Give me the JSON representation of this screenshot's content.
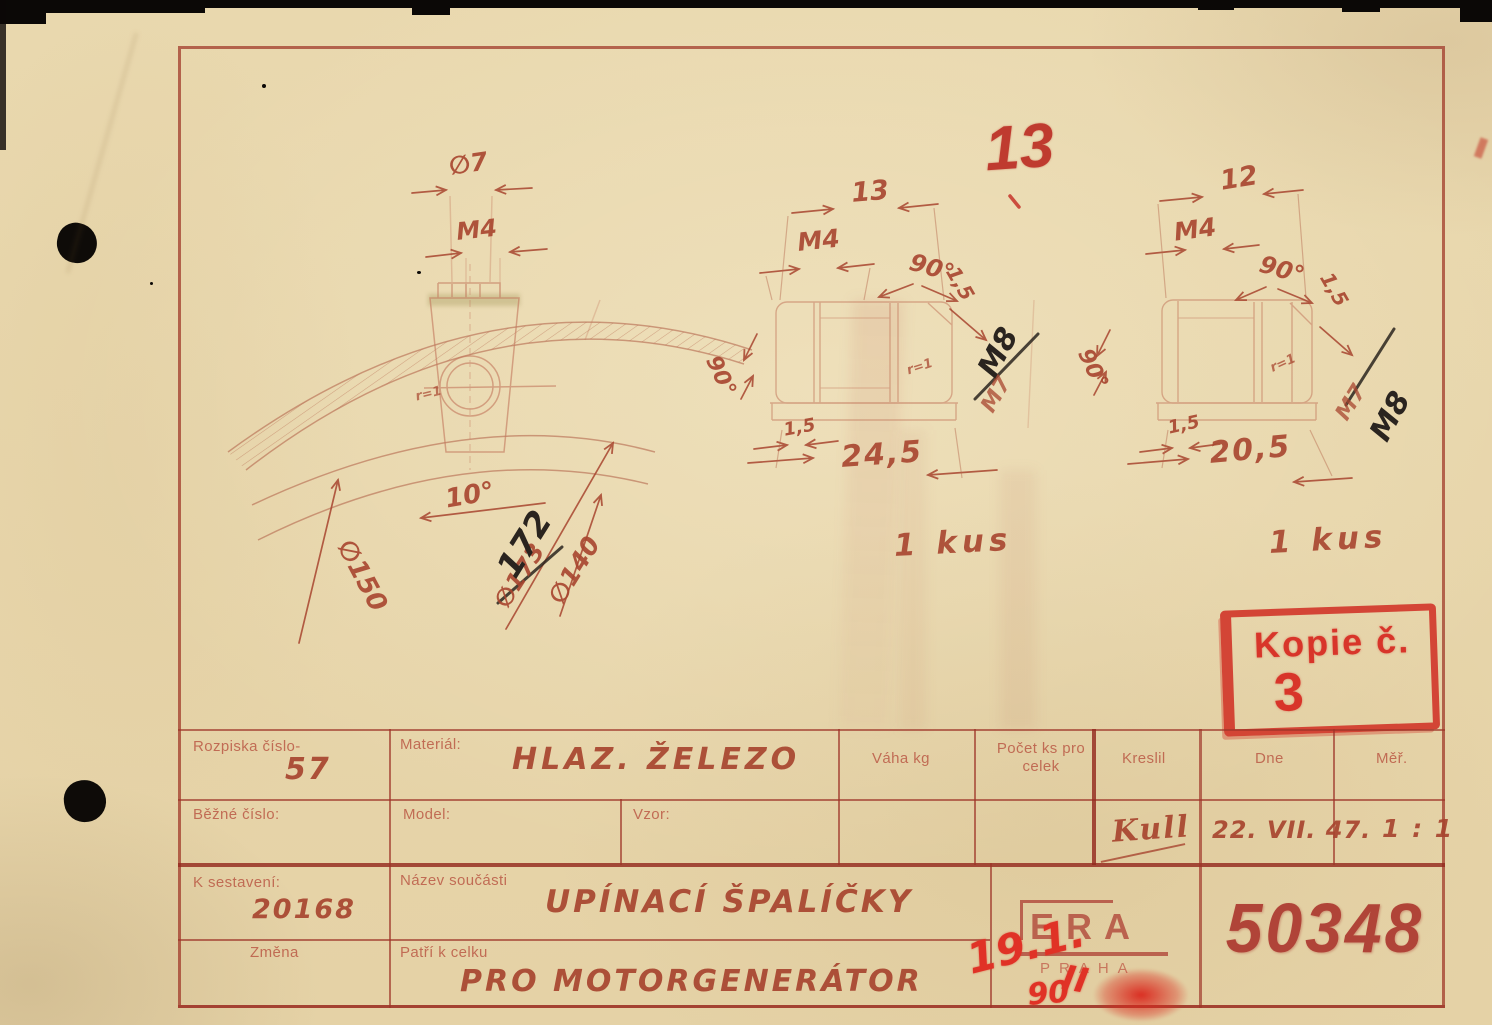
{
  "colors": {
    "paper": "#e9d8ae",
    "ink_red": "#a8452f",
    "stamp_red": "#d03126",
    "pencil_black": "#2a241f",
    "number_red": "#b04438"
  },
  "stamps": {
    "copy_label": "Kopie č.",
    "copy_number": "3",
    "sheet_number": "13",
    "scribble_date": "19.1.",
    "scribble_num": "90",
    "scribble_mark": "II"
  },
  "footer": {
    "logo": "ERA",
    "logo_city": "PRAHA",
    "drawing_number": "50348"
  },
  "title_block": {
    "rozpiska_label": "Rozpiska číslo-",
    "rozpiska_value": "57",
    "bezne_label": "Běžné číslo:",
    "material_label": "Materiál:",
    "material_value": "HLAZ. ŽELEZO",
    "model_label": "Model:",
    "vzor_label": "Vzor:",
    "vaha_label": "Váha kg",
    "pocet_label": "Počet ks pro celek",
    "kreslil_label": "Kreslil",
    "dne_label": "Dne",
    "mer_label": "Měř.",
    "kreslil_value": "Kull",
    "dne_value": "22. VII. 47.",
    "mer_value": "1 : 1",
    "sestaveni_label": "K sestavení:",
    "sestaveni_value": "20168",
    "zmena_label": "Změna",
    "nazev_label": "Název součásti",
    "nazev_value": "UPÍNACÍ ŠPALÍČKY",
    "patri_label": "Patří k celku",
    "patri_value": "PRO MOTORGENERÁTOR"
  },
  "views": {
    "left": {
      "dia_hole": "∅7",
      "thread": "M4",
      "angle": "10°",
      "dia_outer": "∅150",
      "dia_old": "∅173",
      "dia_new": "172",
      "dia_inner": "∅140",
      "radius": "r=1"
    },
    "middle": {
      "width": "13",
      "thread": "M4",
      "angle_right": "90°",
      "chamfer_right": "1,5",
      "angle_left": "90°",
      "thread_old": "M7",
      "thread_new": "M8",
      "chamfer_bottom": "1,5",
      "length": "24,5",
      "radius": "r=1",
      "quantity": "1 kus"
    },
    "right": {
      "width": "12",
      "thread": "M4",
      "angle_right": "90°",
      "chamfer_right": "1,5",
      "angle_left": "90°",
      "thread_old": "M7",
      "thread_new": "M8",
      "chamfer_bottom": "1,5",
      "length": "20,5",
      "radius": "r=1",
      "quantity": "1 kus"
    }
  }
}
